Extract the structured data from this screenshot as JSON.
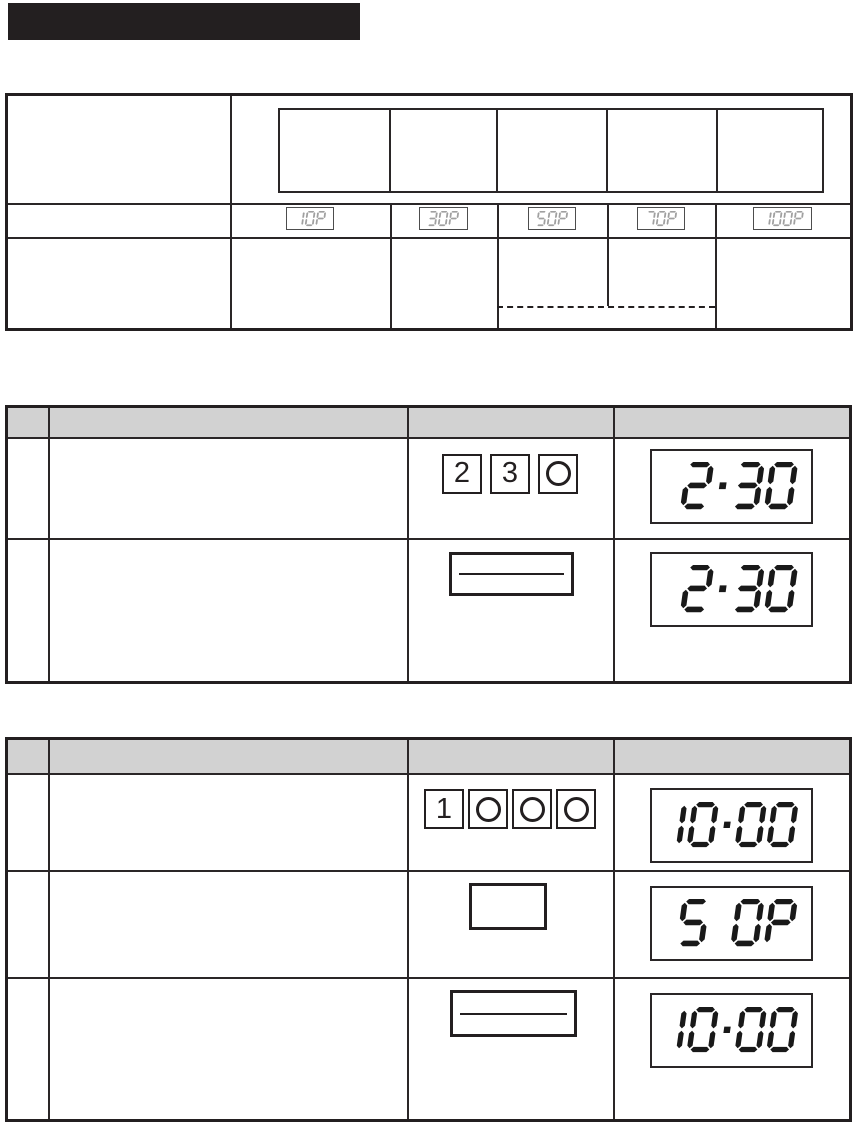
{
  "colors": {
    "ink": "#231f20",
    "header_fill": "#d2d2d2",
    "lcd_small_segments": "#a0a0a0",
    "lcd_dark_segments": "#191919"
  },
  "title_bar": {
    "text": ""
  },
  "power_table": {
    "button_slots": [
      "",
      "",
      "",
      "",
      ""
    ],
    "displays": [
      "10P",
      "30P",
      "50P",
      "70P",
      "100P"
    ]
  },
  "steps_table_1": {
    "rows": [
      {
        "keys": [
          "2",
          "3",
          "0"
        ],
        "display": "2.30"
      },
      {
        "button": "start-bar",
        "display": "2.30"
      }
    ]
  },
  "steps_table_2": {
    "rows": [
      {
        "keys": [
          "1",
          "0",
          "0",
          "0"
        ],
        "display": "10.00"
      },
      {
        "button": "blank",
        "display": "5 0P"
      },
      {
        "button": "start-bar",
        "display": "10.00"
      }
    ]
  }
}
